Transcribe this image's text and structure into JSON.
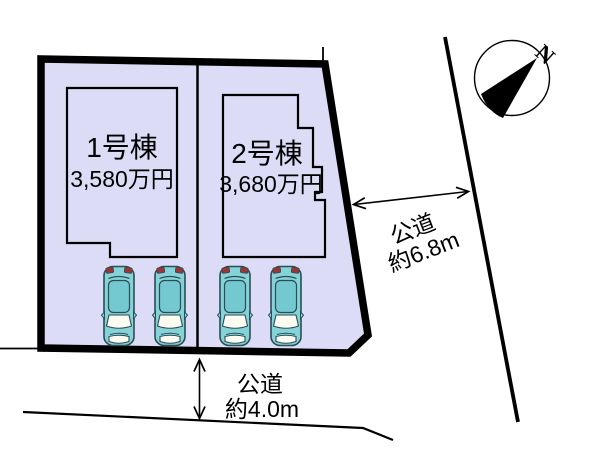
{
  "diagram": {
    "buildings": [
      {
        "name": "1号棟",
        "price": "3,580万円"
      },
      {
        "name": "2号棟",
        "price": "3,680万円"
      }
    ],
    "roads": {
      "east": {
        "name": "公道",
        "width": "約6.8m"
      },
      "south": {
        "name": "公道",
        "width": "約4.0m"
      }
    },
    "compass": {
      "north_label": "N"
    },
    "parking": {
      "car_count": 4
    }
  },
  "colors": {
    "plot_fill": "#dcdcf6",
    "building_fill": "#dcdcf6",
    "outline": "#000000",
    "car_body": "#85d3d9",
    "car_roof": "#74c8d0",
    "car_glass": "#fbfbf2",
    "car_light": "#a03434",
    "car_outline": "#2b4d55"
  }
}
